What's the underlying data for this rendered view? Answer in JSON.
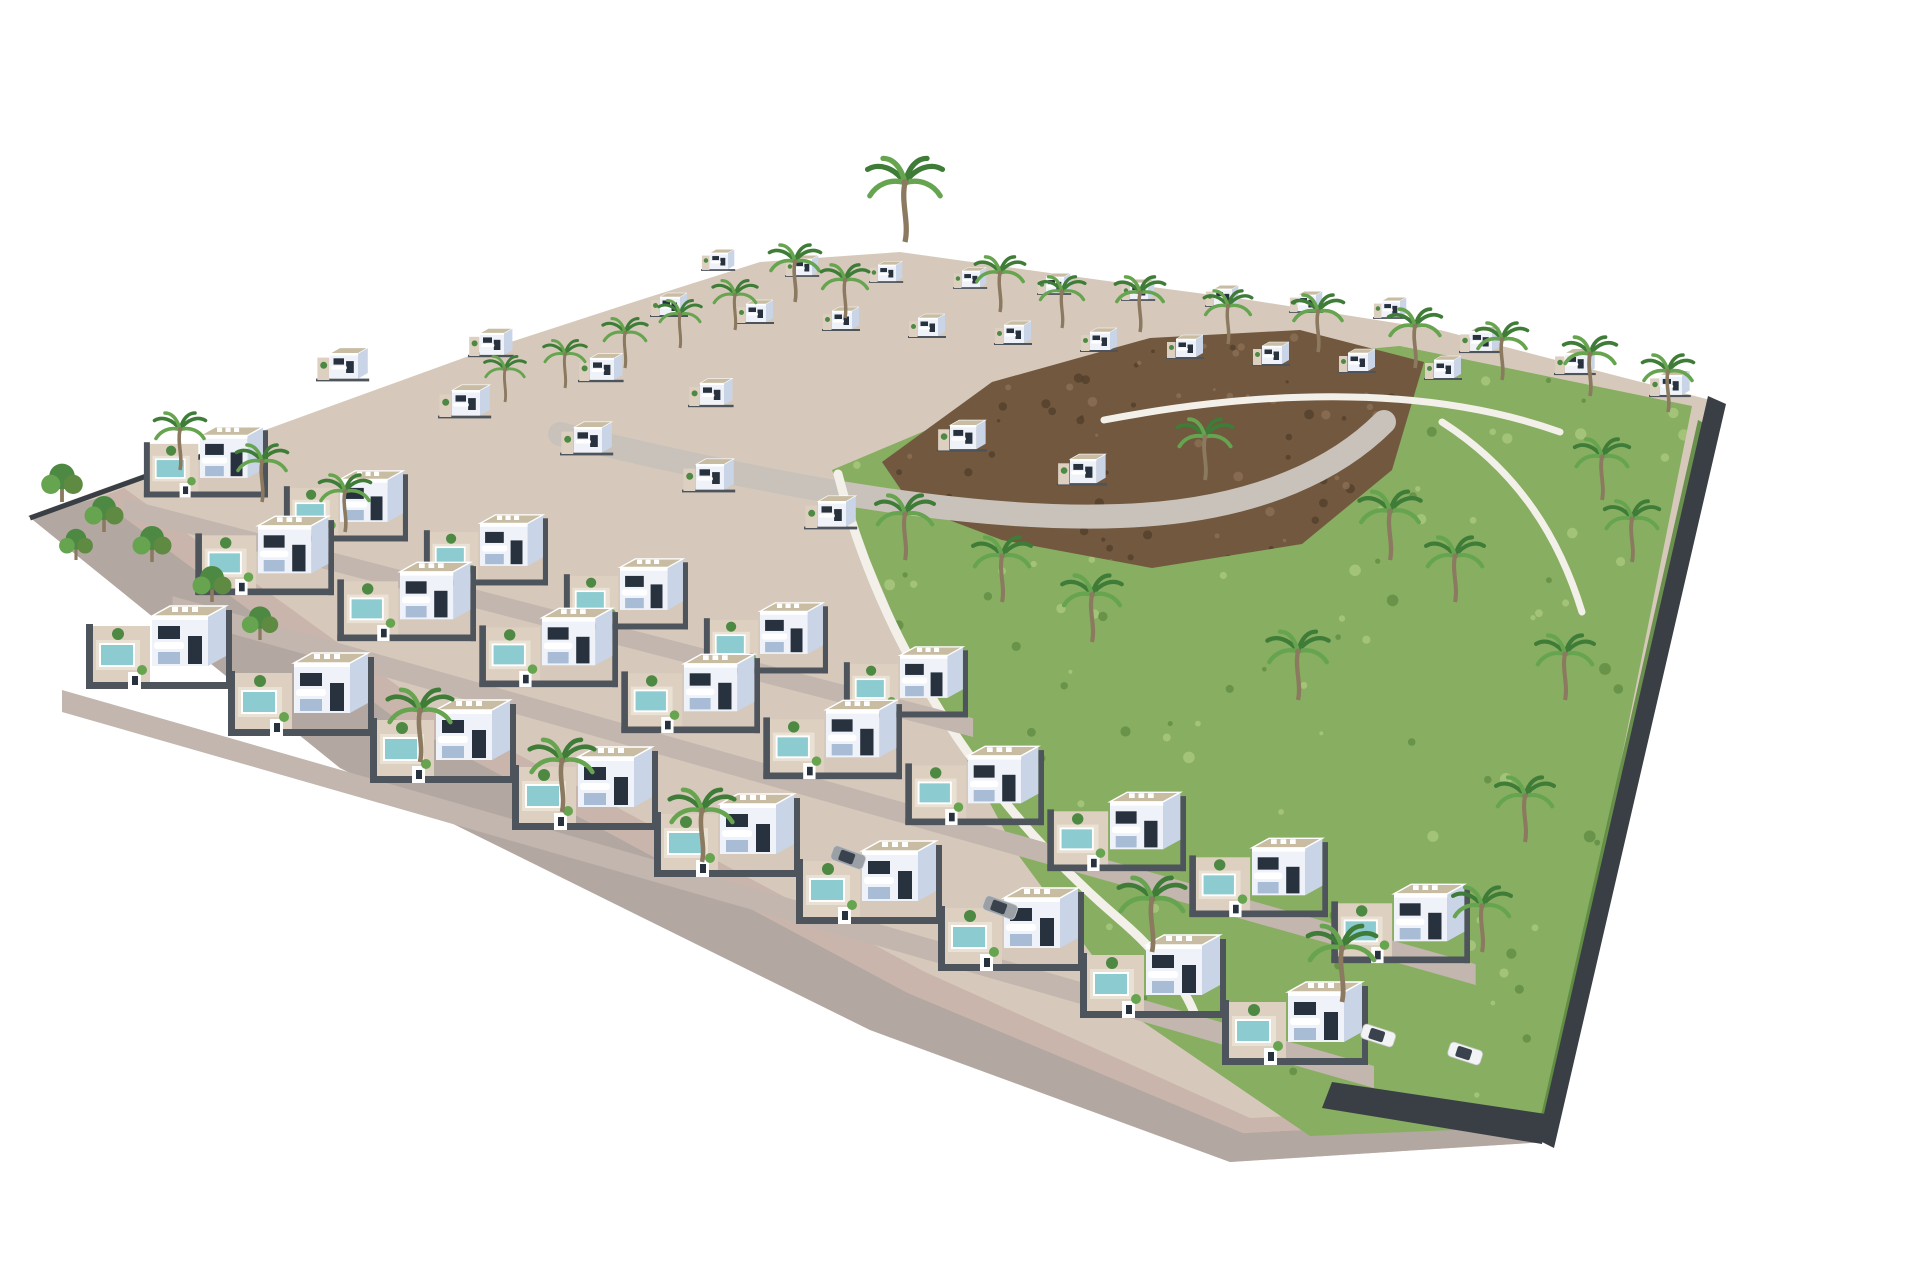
{
  "scene": {
    "type": "aerial-architectural-render",
    "description": "Aerial 3D rendering of a modern residential development: rows of white cubic villas with rooftop terraces, private pools and palm trees, a green hillside with a rocky mound on the right, dark plot walls, and a perimeter road wrapping the lower-left edge on a white background.",
    "background": "#ffffff"
  },
  "inventory": {
    "villas": 56,
    "pools": 24,
    "palm_trees": 37,
    "garden_trees": 6,
    "cars": 4
  },
  "colors": {
    "background": "#ffffff",
    "ground": "#d6c9bb",
    "ground_light": "#ddd0c0",
    "road": "#b3a7a1",
    "sidewalk": "#c9b5ab",
    "street": "#c2b6ae",
    "internal_road": "#c9c2bb",
    "house_front": "#eff3f9",
    "house_side": "#c9d5e7",
    "house_shade": "#a9bcd6",
    "roof": "#c8bda3",
    "roof_edge": "#ffffff",
    "window": "#28323f",
    "plot_wall": "#4e545c",
    "fence": "#3a3f46",
    "pool": "#8ccbd0",
    "pool_deck": "#e9e1d3",
    "hill": "#87ae61",
    "hill_dark": "#5e8a41",
    "hill_light": "#abca80",
    "rock": "#72583f",
    "rock_dark": "#513d2b",
    "rock_light": "#8d7258",
    "palm": "#3f7c38",
    "palm_light": "#66a44f",
    "trunk": "#8c7a60",
    "tree": "#4d8943",
    "wall_white": "#f3f0ea",
    "car_white": "#f2f3f4",
    "car_gray": "#9aa0a6",
    "car_glass": "#39424d"
  },
  "site": {
    "ground_points": "28,516 480,352 640,300 760,262 900,252 1100,280 1250,300 1440,330 1718,402 1546,1142 1230,1162 870,1030 340,768"
  },
  "road": {
    "points": "28,516 340,768 870,1030 1230,1162 1546,1142 1546,1118 1243,1133 908,993 398,720 98,498"
  },
  "sidewalk": {
    "points": "98,498 398,720 908,993 1243,1133 1546,1118 1546,1104 1250,1118 925,972 420,702 124,488"
  },
  "hill": {
    "points": "832,470 960,416 1140,370 1400,346 1692,406 1548,1126 1310,1136 1140,1020 1016,852 906,646",
    "bbox": [
      832,
      340,
      860,
      790
    ],
    "dot_count": 170
  },
  "rocks": {
    "points": "882,462 992,382 1150,338 1300,330 1424,362 1392,470 1302,544 1152,568 1002,540 912,506",
    "bbox": [
      882,
      330,
      542,
      238
    ],
    "dot_count": 90
  },
  "internal_road": {
    "d": "M560,434 C760,482 960,522 1120,516 C1266,511 1344,462 1384,422",
    "width": 24
  },
  "walls": {
    "retaining_d": "M838,474 C880,640 980,800 1118,918 C1158,952 1186,988 1196,1018",
    "hill_top_d": "M1104,420 C1250,392 1420,382 1560,432",
    "hill_right_d": "M1442,422 C1520,472 1560,540 1582,612"
  },
  "fences": {
    "right_points": "1708,396 1726,404 1554,1148 1538,1140",
    "hedge_points": "1698,420 1710,426 1550,1128 1540,1120",
    "left_d": "M30,518 L252,438",
    "corner_points": "1332,1082 1546,1114 1542,1144 1322,1108"
  },
  "rows": [
    {
      "id": "ridge-row",
      "x0": 710,
      "y0": 252,
      "dx": 84,
      "dy": 6,
      "count": 9,
      "s": 0.45,
      "kind": "small"
    },
    {
      "id": "upper-row",
      "x0": 660,
      "y0": 296,
      "dx": 86,
      "dy": 7,
      "count": 10,
      "s": 0.5,
      "kind": "small"
    },
    {
      "id": "top-right-row",
      "x0": 1470,
      "y0": 330,
      "dx": 95,
      "dy": 22,
      "count": 3,
      "s": 0.55,
      "kind": "small"
    },
    {
      "id": "mid-upper-row",
      "x0": 480,
      "y0": 332,
      "dx": 110,
      "dy": 25,
      "count": 3,
      "s": 0.6,
      "kind": "small"
    },
    {
      "id": "center-left-row",
      "x0": 330,
      "y0": 352,
      "dx": 122,
      "dy": 37,
      "count": 5,
      "s": 0.7,
      "kind": "small"
    },
    {
      "id": "center-right-pair",
      "x0": 950,
      "y0": 424,
      "dx": 120,
      "dy": 34,
      "count": 2,
      "s": 0.66,
      "kind": "small"
    },
    {
      "id": "third-row",
      "x0": 200,
      "y0": 432,
      "dx": 140,
      "dy": 44,
      "count": 6,
      "s": 0.85,
      "kind": "garden",
      "pool": true
    },
    {
      "id": "second-row",
      "x0": 258,
      "y0": 522,
      "dx": 142,
      "dy": 46,
      "count": 9,
      "s": 0.95,
      "kind": "garden",
      "pool": true
    },
    {
      "id": "front-row",
      "x0": 152,
      "y0": 612,
      "dx": 142,
      "dy": 47,
      "count": 9,
      "s": 1.0,
      "kind": "garden",
      "pool": true
    }
  ],
  "palms": [
    [
      905,
      242,
      2.2
    ],
    [
      795,
      302,
      1.5
    ],
    [
      845,
      318,
      1.4
    ],
    [
      735,
      330,
      1.3
    ],
    [
      680,
      348,
      1.25
    ],
    [
      625,
      368,
      1.3
    ],
    [
      565,
      388,
      1.25
    ],
    [
      505,
      402,
      1.2
    ],
    [
      1000,
      312,
      1.45
    ],
    [
      1062,
      328,
      1.35
    ],
    [
      1140,
      332,
      1.45
    ],
    [
      1228,
      344,
      1.4
    ],
    [
      1318,
      352,
      1.5
    ],
    [
      1415,
      368,
      1.55
    ],
    [
      1502,
      380,
      1.5
    ],
    [
      1590,
      396,
      1.55
    ],
    [
      1668,
      412,
      1.5
    ],
    [
      180,
      470,
      1.5
    ],
    [
      262,
      502,
      1.5
    ],
    [
      345,
      532,
      1.5
    ],
    [
      905,
      560,
      1.7
    ],
    [
      1002,
      602,
      1.7
    ],
    [
      1092,
      642,
      1.75
    ],
    [
      1205,
      480,
      1.6
    ],
    [
      1390,
      560,
      1.8
    ],
    [
      1455,
      602,
      1.7
    ],
    [
      1298,
      700,
      1.8
    ],
    [
      420,
      762,
      1.9
    ],
    [
      562,
      812,
      1.9
    ],
    [
      702,
      862,
      1.9
    ],
    [
      1152,
      952,
      1.95
    ],
    [
      1342,
      1002,
      2.0
    ],
    [
      1602,
      500,
      1.6
    ],
    [
      1632,
      562,
      1.6
    ],
    [
      1565,
      700,
      1.7
    ],
    [
      1525,
      842,
      1.7
    ],
    [
      1482,
      952,
      1.7
    ]
  ],
  "trees": [
    [
      62,
      502,
      1.6
    ],
    [
      104,
      532,
      1.5
    ],
    [
      152,
      562,
      1.5
    ],
    [
      212,
      602,
      1.5
    ],
    [
      76,
      560,
      1.3
    ],
    [
      260,
      640,
      1.4
    ]
  ],
  "cars": [
    [
      1378,
      1036,
      18,
      "car_white"
    ],
    [
      1465,
      1054,
      18,
      "car_white"
    ],
    [
      848,
      858,
      20,
      "car_gray"
    ],
    [
      1000,
      908,
      20,
      "car_gray"
    ]
  ]
}
